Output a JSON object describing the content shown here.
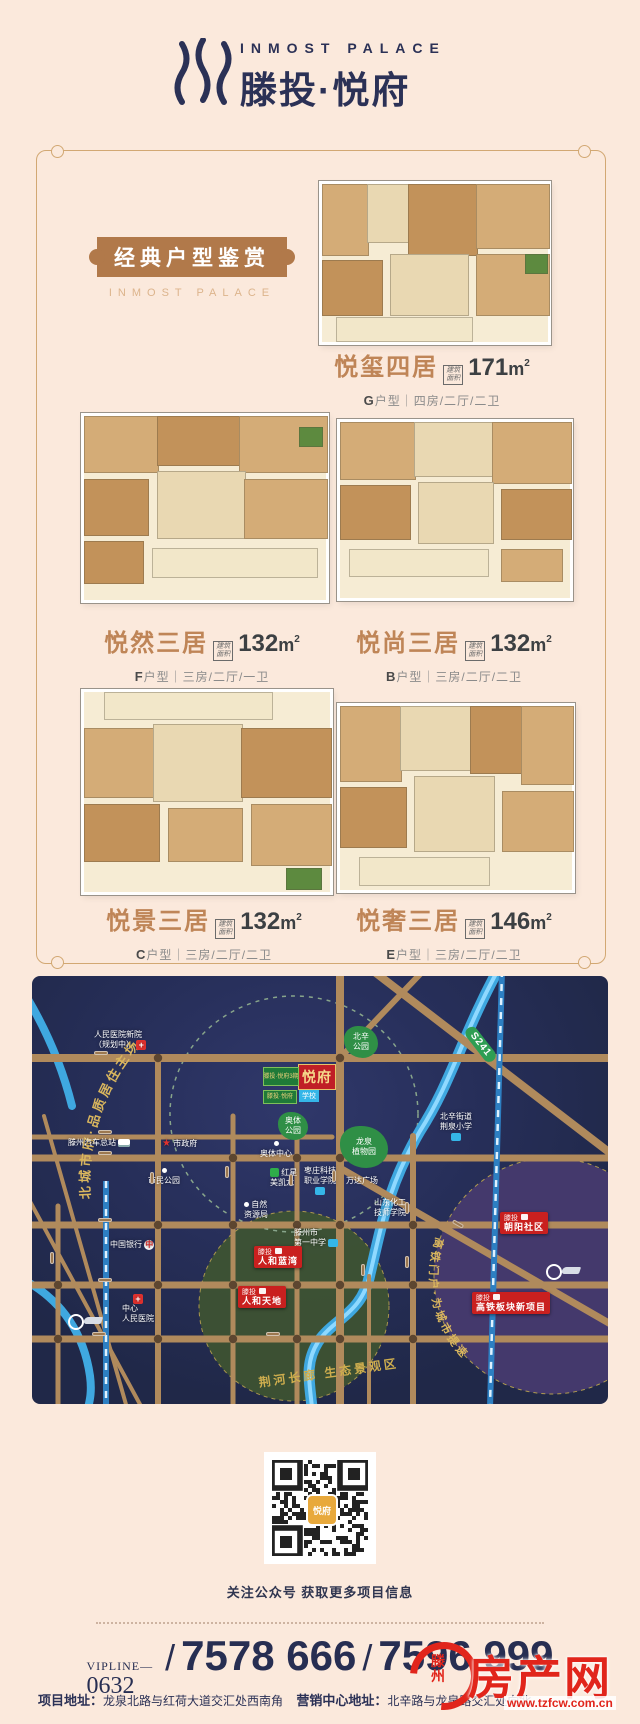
{
  "header": {
    "brand_en": "INMOST PALACE",
    "brand_cn": "滕投·悦府"
  },
  "gallery": {
    "badge": "经典户型鉴赏",
    "badge_sub": "INMOST PALACE",
    "area_badge_l1": "建筑",
    "area_badge_l2": "面积",
    "area_unit": "m",
    "area_sup": "2",
    "plans": [
      {
        "name": "悦玺四居",
        "area": "171",
        "letter": "G",
        "type_rest": "户型｜四房/二厅/二卫"
      },
      {
        "name": "悦然三居",
        "area": "132",
        "letter": "F",
        "type_rest": "户型｜三房/二厅/一卫"
      },
      {
        "name": "悦尚三居",
        "area": "132",
        "letter": "B",
        "type_rest": "户型｜三房/二厅/二卫"
      },
      {
        "name": "悦景三居",
        "area": "132",
        "letter": "C",
        "type_rest": "户型｜三房/二厅/二卫"
      },
      {
        "name": "悦奢三居",
        "area": "146",
        "letter": "E",
        "type_rest": "户型｜三房/二厅/二卫"
      }
    ]
  },
  "map": {
    "slogan_top": "北城市府·品质居住主场",
    "slogan_right": "高铁门户·为城市提速",
    "slogan_bottom": "荆河长廊 生态景观区",
    "s241": "S241",
    "project": {
      "main": "悦府",
      "sub1": "滕投·悦府3期",
      "sub2": "滕投·悦府",
      "school": "学校"
    },
    "roads_h": [
      {
        "t": "红荷大道",
        "x": 62,
        "y": 75
      },
      {
        "t": "通盛路",
        "x": 66,
        "y": 154
      },
      {
        "t": "北辛路",
        "x": 66,
        "y": 175
      },
      {
        "t": "学院路",
        "x": 66,
        "y": 242
      },
      {
        "t": "解放路",
        "x": 66,
        "y": 302
      },
      {
        "t": "荆河路",
        "x": 60,
        "y": 356
      },
      {
        "t": "荆河路",
        "x": 234,
        "y": 356
      }
    ],
    "roads_v": [
      {
        "t": "平行路",
        "x": 18,
        "y": 276
      },
      {
        "t": "善国路",
        "x": 118,
        "y": 196
      },
      {
        "t": "塔寺路",
        "x": 193,
        "y": 190
      },
      {
        "t": "文化路",
        "x": 257,
        "y": 198
      },
      {
        "t": "龙泉路",
        "x": 300,
        "y": 194
      },
      {
        "t": "保通路",
        "x": 373,
        "y": 226
      },
      {
        "t": "府东路",
        "x": 329,
        "y": 288
      },
      {
        "t": "京台高速",
        "x": 373,
        "y": 280
      }
    ],
    "roads_d": [
      {
        "t": "北辛东路",
        "x": 420,
        "y": 246,
        "r": 30
      }
    ],
    "pois": [
      {
        "t": "人民医院新院",
        "t2": "（规划中）",
        "x": 62,
        "y": 54,
        "ic": "cross",
        "ip": "right"
      },
      {
        "t": "滕州汽车总站",
        "x": 36,
        "y": 162,
        "ic": "bus",
        "ip": "right"
      },
      {
        "t": "市政府",
        "x": 130,
        "y": 163,
        "ic": "star",
        "ip": "left"
      },
      {
        "t": "市民公园",
        "x": 116,
        "y": 190,
        "ic": "dot",
        "ip": "top"
      },
      {
        "t": "奥体中心",
        "x": 228,
        "y": 163,
        "ic": "dot",
        "ip": "top"
      },
      {
        "t": "红星",
        "t2": "美凯龙",
        "x": 238,
        "y": 192,
        "ic": "mall",
        "ip": "left"
      },
      {
        "t": "枣庄科技",
        "t2": "职业学院",
        "x": 272,
        "y": 190,
        "ic": "school",
        "ip": "bottom"
      },
      {
        "t": "自然",
        "t2": "资源局",
        "x": 212,
        "y": 224,
        "ic": "dot",
        "ip": "left"
      },
      {
        "t": "中国银行",
        "x": 78,
        "y": 264,
        "ic": "bank",
        "ip": "right"
      },
      {
        "t": "滕州市",
        "t2": "第一中学",
        "x": 262,
        "y": 252,
        "ic": "school",
        "ip": "right"
      },
      {
        "t": "万达广场",
        "x": 314,
        "y": 200
      },
      {
        "t": "山东化工",
        "t2": "技师学院",
        "x": 342,
        "y": 222
      },
      {
        "t": "北辛街道",
        "t2": "荆泉小学",
        "x": 408,
        "y": 136,
        "ic": "school",
        "ip": "bottom"
      },
      {
        "t": "中心",
        "t2": "人民医院",
        "x": 90,
        "y": 318,
        "ic": "cross",
        "ip": "top"
      }
    ],
    "stations": [
      {
        "t": "滕州站",
        "x": 40,
        "y": 316,
        "tx": 36,
        "ty": 338
      },
      {
        "t": "滕州东站",
        "x": 448,
        "y": 286,
        "tx": 514,
        "ty": 288
      }
    ],
    "parks": [
      {
        "t": "北辛",
        "t2": "公园",
        "x": 312,
        "y": 50,
        "w": 34,
        "h": 32
      },
      {
        "t": "龙泉",
        "t2": "植物园",
        "x": 308,
        "y": 150,
        "w": 48,
        "h": 42
      },
      {
        "t": "奥体",
        "t2": "公园",
        "x": 246,
        "y": 136,
        "w": 30,
        "h": 28
      }
    ],
    "markers": [
      {
        "l1": "滕投",
        "l2": "人和蓝湾",
        "x": 222,
        "y": 270
      },
      {
        "l1": "滕投",
        "l2": "人和天地",
        "x": 206,
        "y": 310
      },
      {
        "l1": "滕投",
        "l2": "朝阳社区",
        "x": 468,
        "y": 236
      },
      {
        "l1": "滕投",
        "l2": "高铁板块新项目",
        "x": 440,
        "y": 316
      }
    ]
  },
  "footer": {
    "qr_caption": "关注公众号  获取更多项目信息",
    "vip": "VIPLINE—",
    "code": "0632",
    "slash1": "/",
    "slash2": "/",
    "phone1": "7578 666",
    "phone2": "7596 999",
    "addr_label": "项目地址：",
    "addr": "龙泉北路与红荷大道交汇处西南角",
    "sales_label": "营销中心地址：",
    "sales": "北辛路与龙泉路交汇处向北",
    "wm_site": "房产网",
    "wm_city": "滕州",
    "wm_url": "www.tzfcw.com.cn",
    "qr_center": "悦府"
  }
}
